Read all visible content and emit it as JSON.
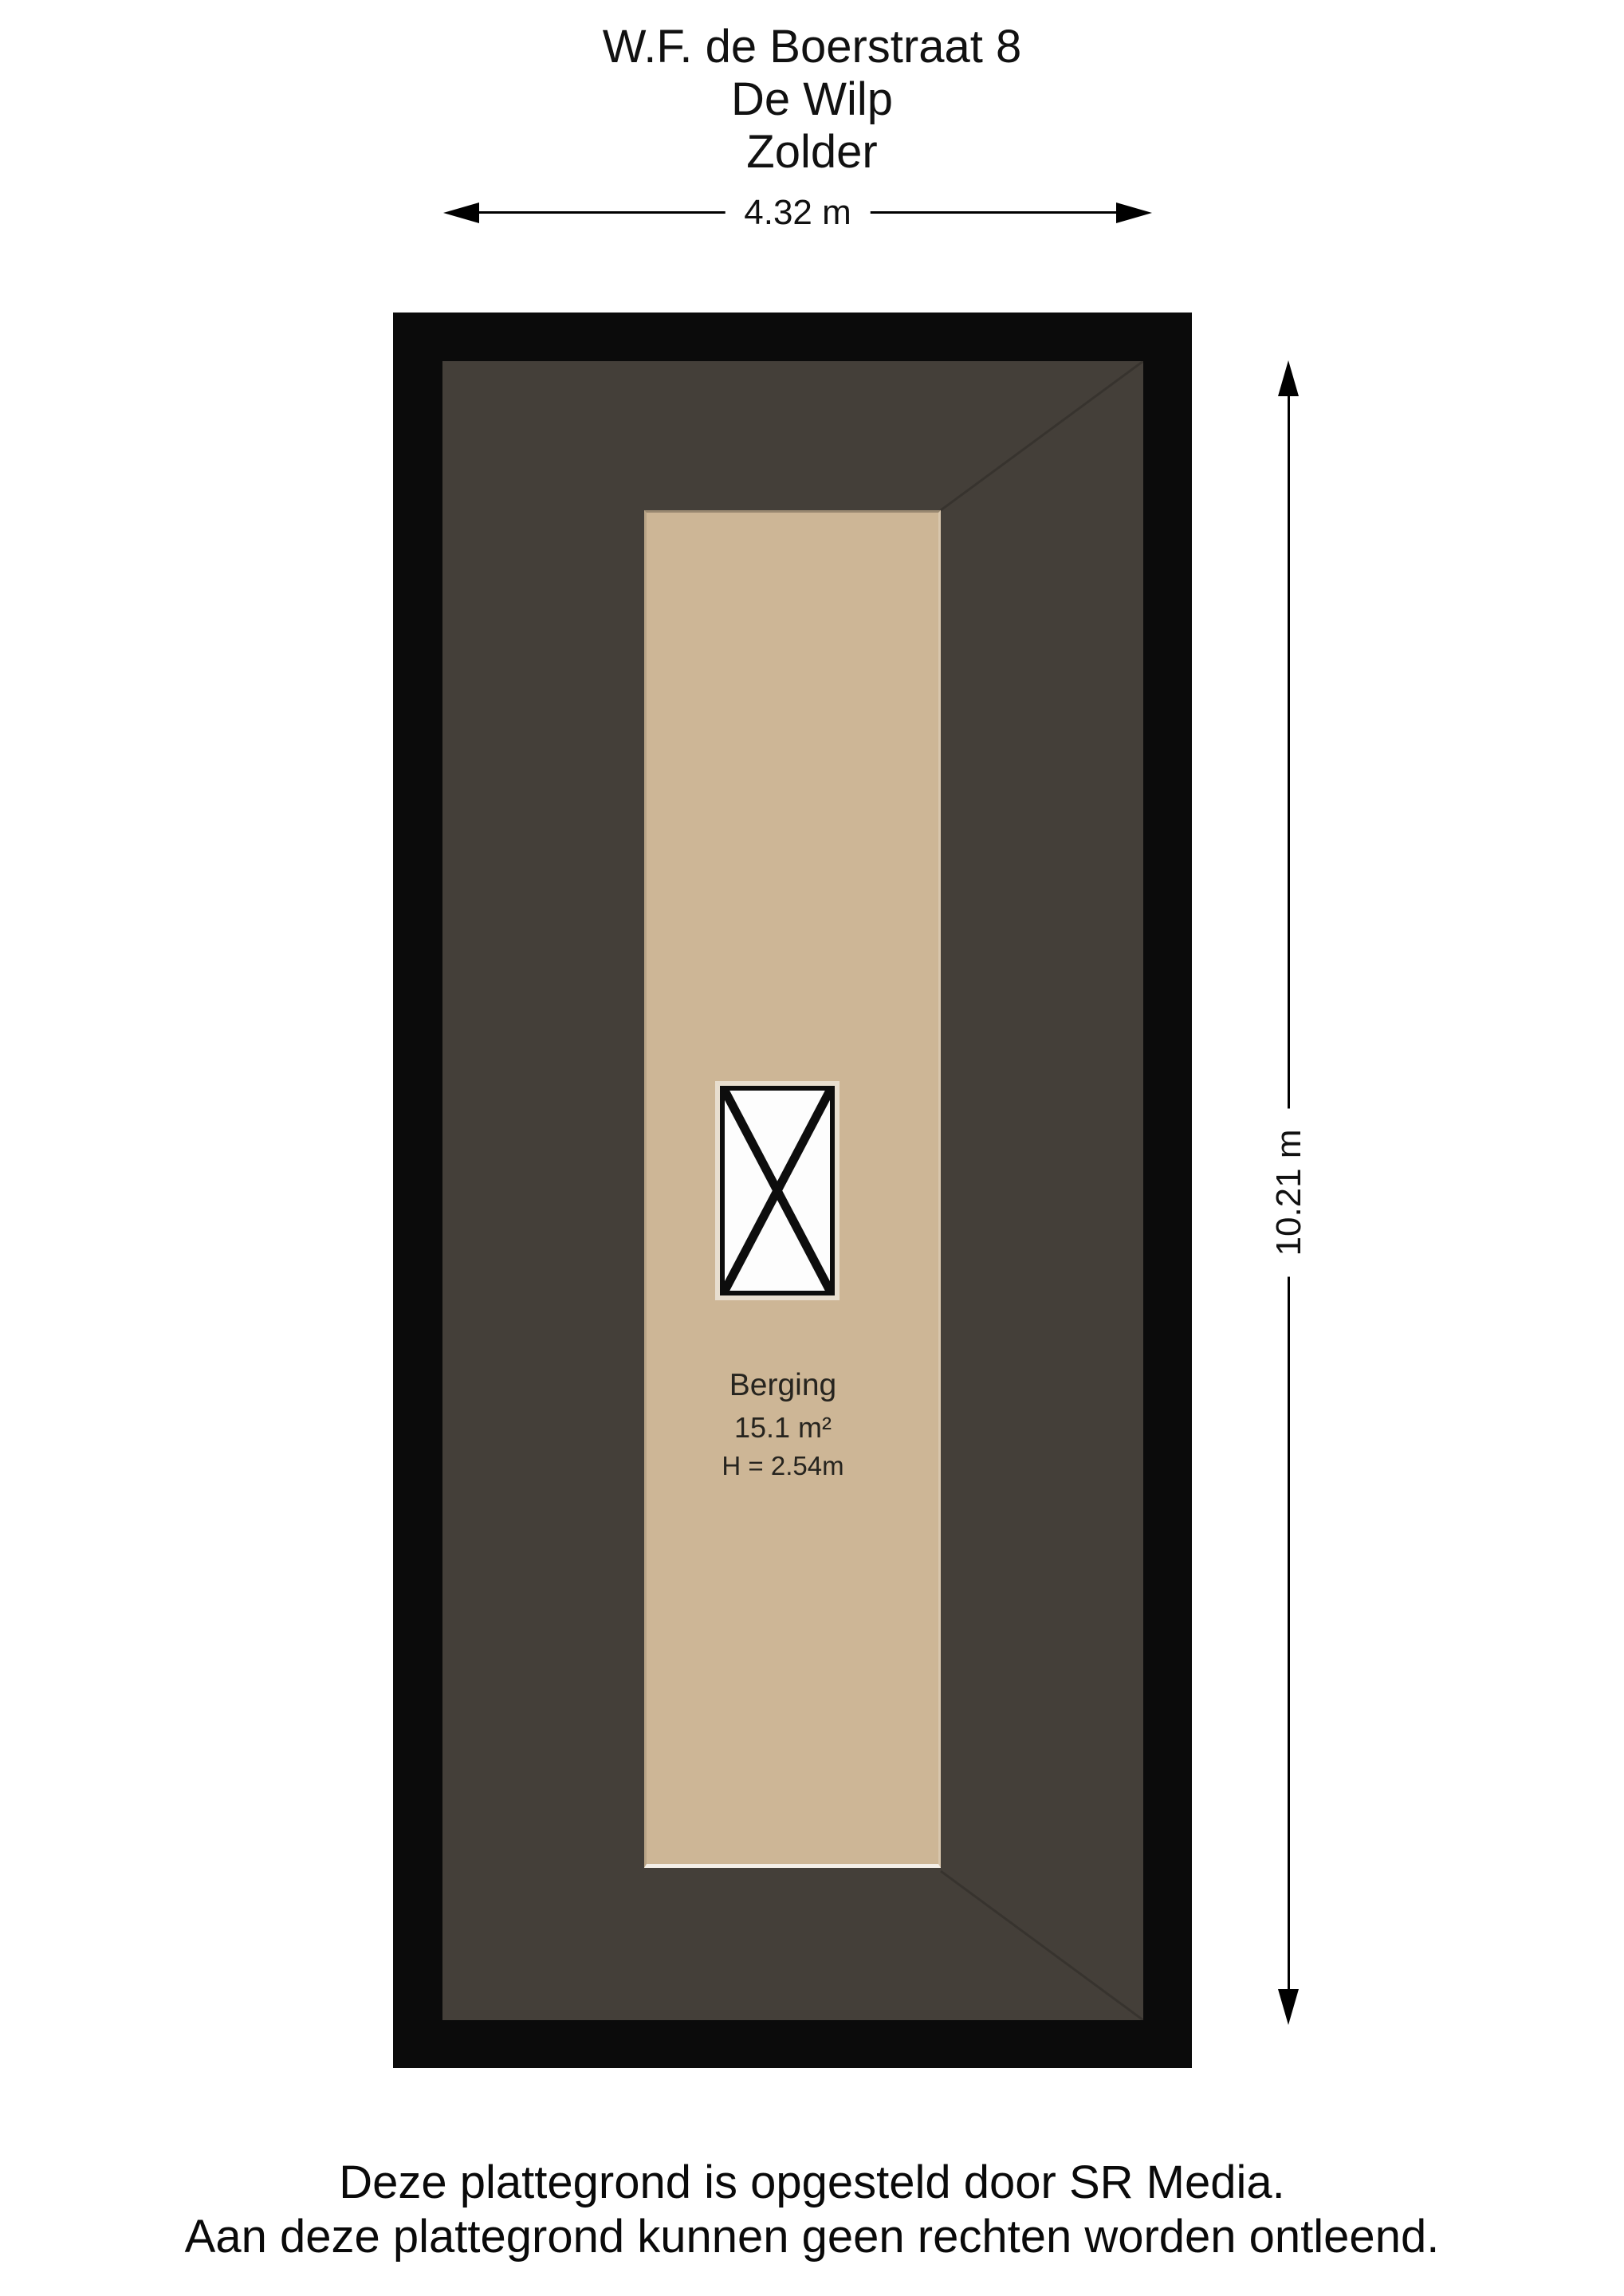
{
  "title": {
    "address": "W.F. de Boerstraat 8",
    "city": "De Wilp",
    "floor": "Zolder"
  },
  "dimensions": {
    "width_label": "4.32 m",
    "height_label": "10.21 m"
  },
  "room": {
    "name": "Berging",
    "area": "15.1 m²",
    "height": "H = 2.54m"
  },
  "footer": {
    "line1": "Deze plattegrond is opgesteld door SR Media.",
    "line2": "Aan deze plattegrond kunnen geen rechten worden ontleend."
  },
  "colors": {
    "background": "#ffffff",
    "wall": "#0b0b0b",
    "floor_dark": "#443f39",
    "floor_room": "#cdb696",
    "stair_fill": "#fdfdfd"
  }
}
